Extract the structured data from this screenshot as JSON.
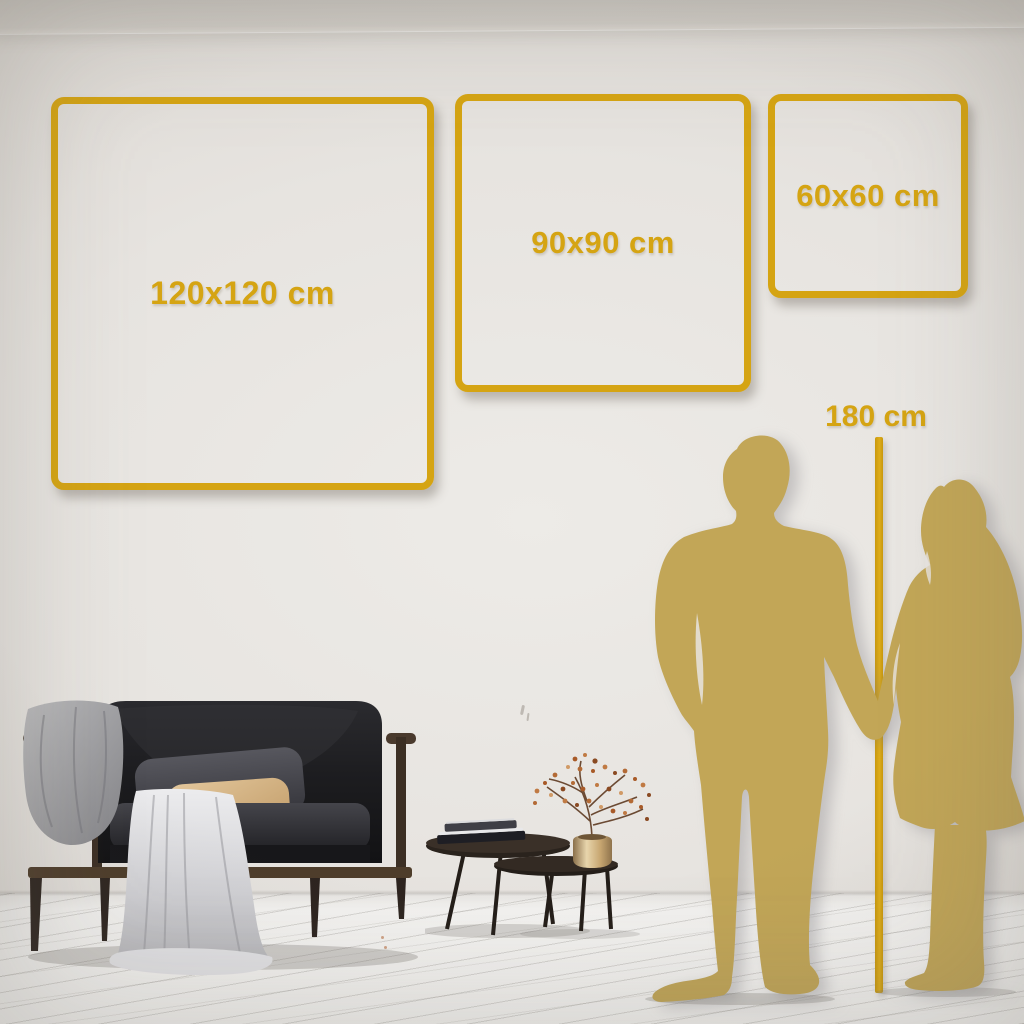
{
  "size_guide": {
    "frames": [
      {
        "id": "frame-120",
        "label": "120x120 cm"
      },
      {
        "id": "frame-90",
        "label": "90x90 cm"
      },
      {
        "id": "frame-60",
        "label": "60x60 cm"
      }
    ],
    "height_marker": {
      "label": "180 cm"
    }
  },
  "figures": {
    "man": "man-silhouette",
    "woman": "woman-silhouette"
  },
  "colors": {
    "accent_gold": "#D5A413",
    "silhouette_gold": "#C2A657",
    "wall": "#E7E4E0",
    "ceiling": "#CCC8C2",
    "floor": "#F4F3F1",
    "sofa_dark": "#1F1F22",
    "wood_frame": "#4A3A2D",
    "pillow_beige": "#D8BA8C",
    "pillow_gray": "#4A4A50",
    "blanket_gray": "#AFAFB2",
    "drape_white": "#DEDEE1",
    "vase_gold": "#D9C08E",
    "blossom_rust": "#B5672F"
  }
}
